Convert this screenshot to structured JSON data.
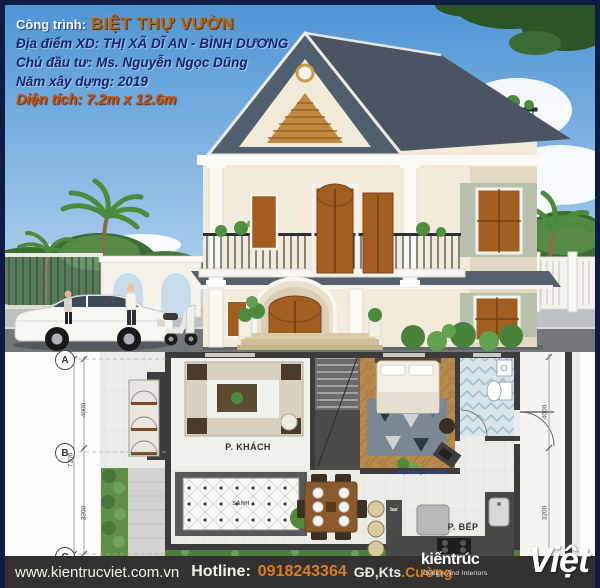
{
  "overlay": {
    "project_label": "Công trình:",
    "project_name": "BIỆT THỰ VƯỜN",
    "location": "Địa điểm XD: THỊ XÃ DĨ AN - BÌNH DƯƠNG",
    "owner": "Chủ đầu tư: Ms. Nguyễn Ngọc Dũng",
    "year": "Năm xây dựng: 2019",
    "area": "Diện tích: 7.2m x 12.6m"
  },
  "floorplan": {
    "grid": {
      "a": "A",
      "b": "B",
      "c": "C"
    },
    "dims_left": [
      "4000",
      "7200",
      "3200"
    ],
    "dims_right": [
      "4000",
      "3200"
    ],
    "labels": {
      "living": "P. KHÁCH",
      "kitchen": "P. BẾP",
      "hall": "SẢNH",
      "bar": "bar"
    },
    "note": "xây tường cao 1600"
  },
  "footer": {
    "website": "www.kientrucviet.com.vn",
    "hotline_label": "Hotline:",
    "phone": "0918243364",
    "title_text": "GĐ,Kts",
    "name_text": ".Cường",
    "logo": {
      "line1": "kiếntrúc",
      "main": "Việt",
      "tagline": "Design And Interiors"
    }
  },
  "colors": {
    "frame_navy": "#0d1b45",
    "overlay_navy": "#17246e",
    "title_orange": "#b5641c",
    "area_orange": "#c9520f",
    "footer_bg": "#343230",
    "footer_orange": "#dd7d22",
    "sky_top": "#4e95d5",
    "roof_slate": "#4a5462",
    "door_wood": "#a25e20",
    "plan_wall": "#3c3c3c"
  }
}
